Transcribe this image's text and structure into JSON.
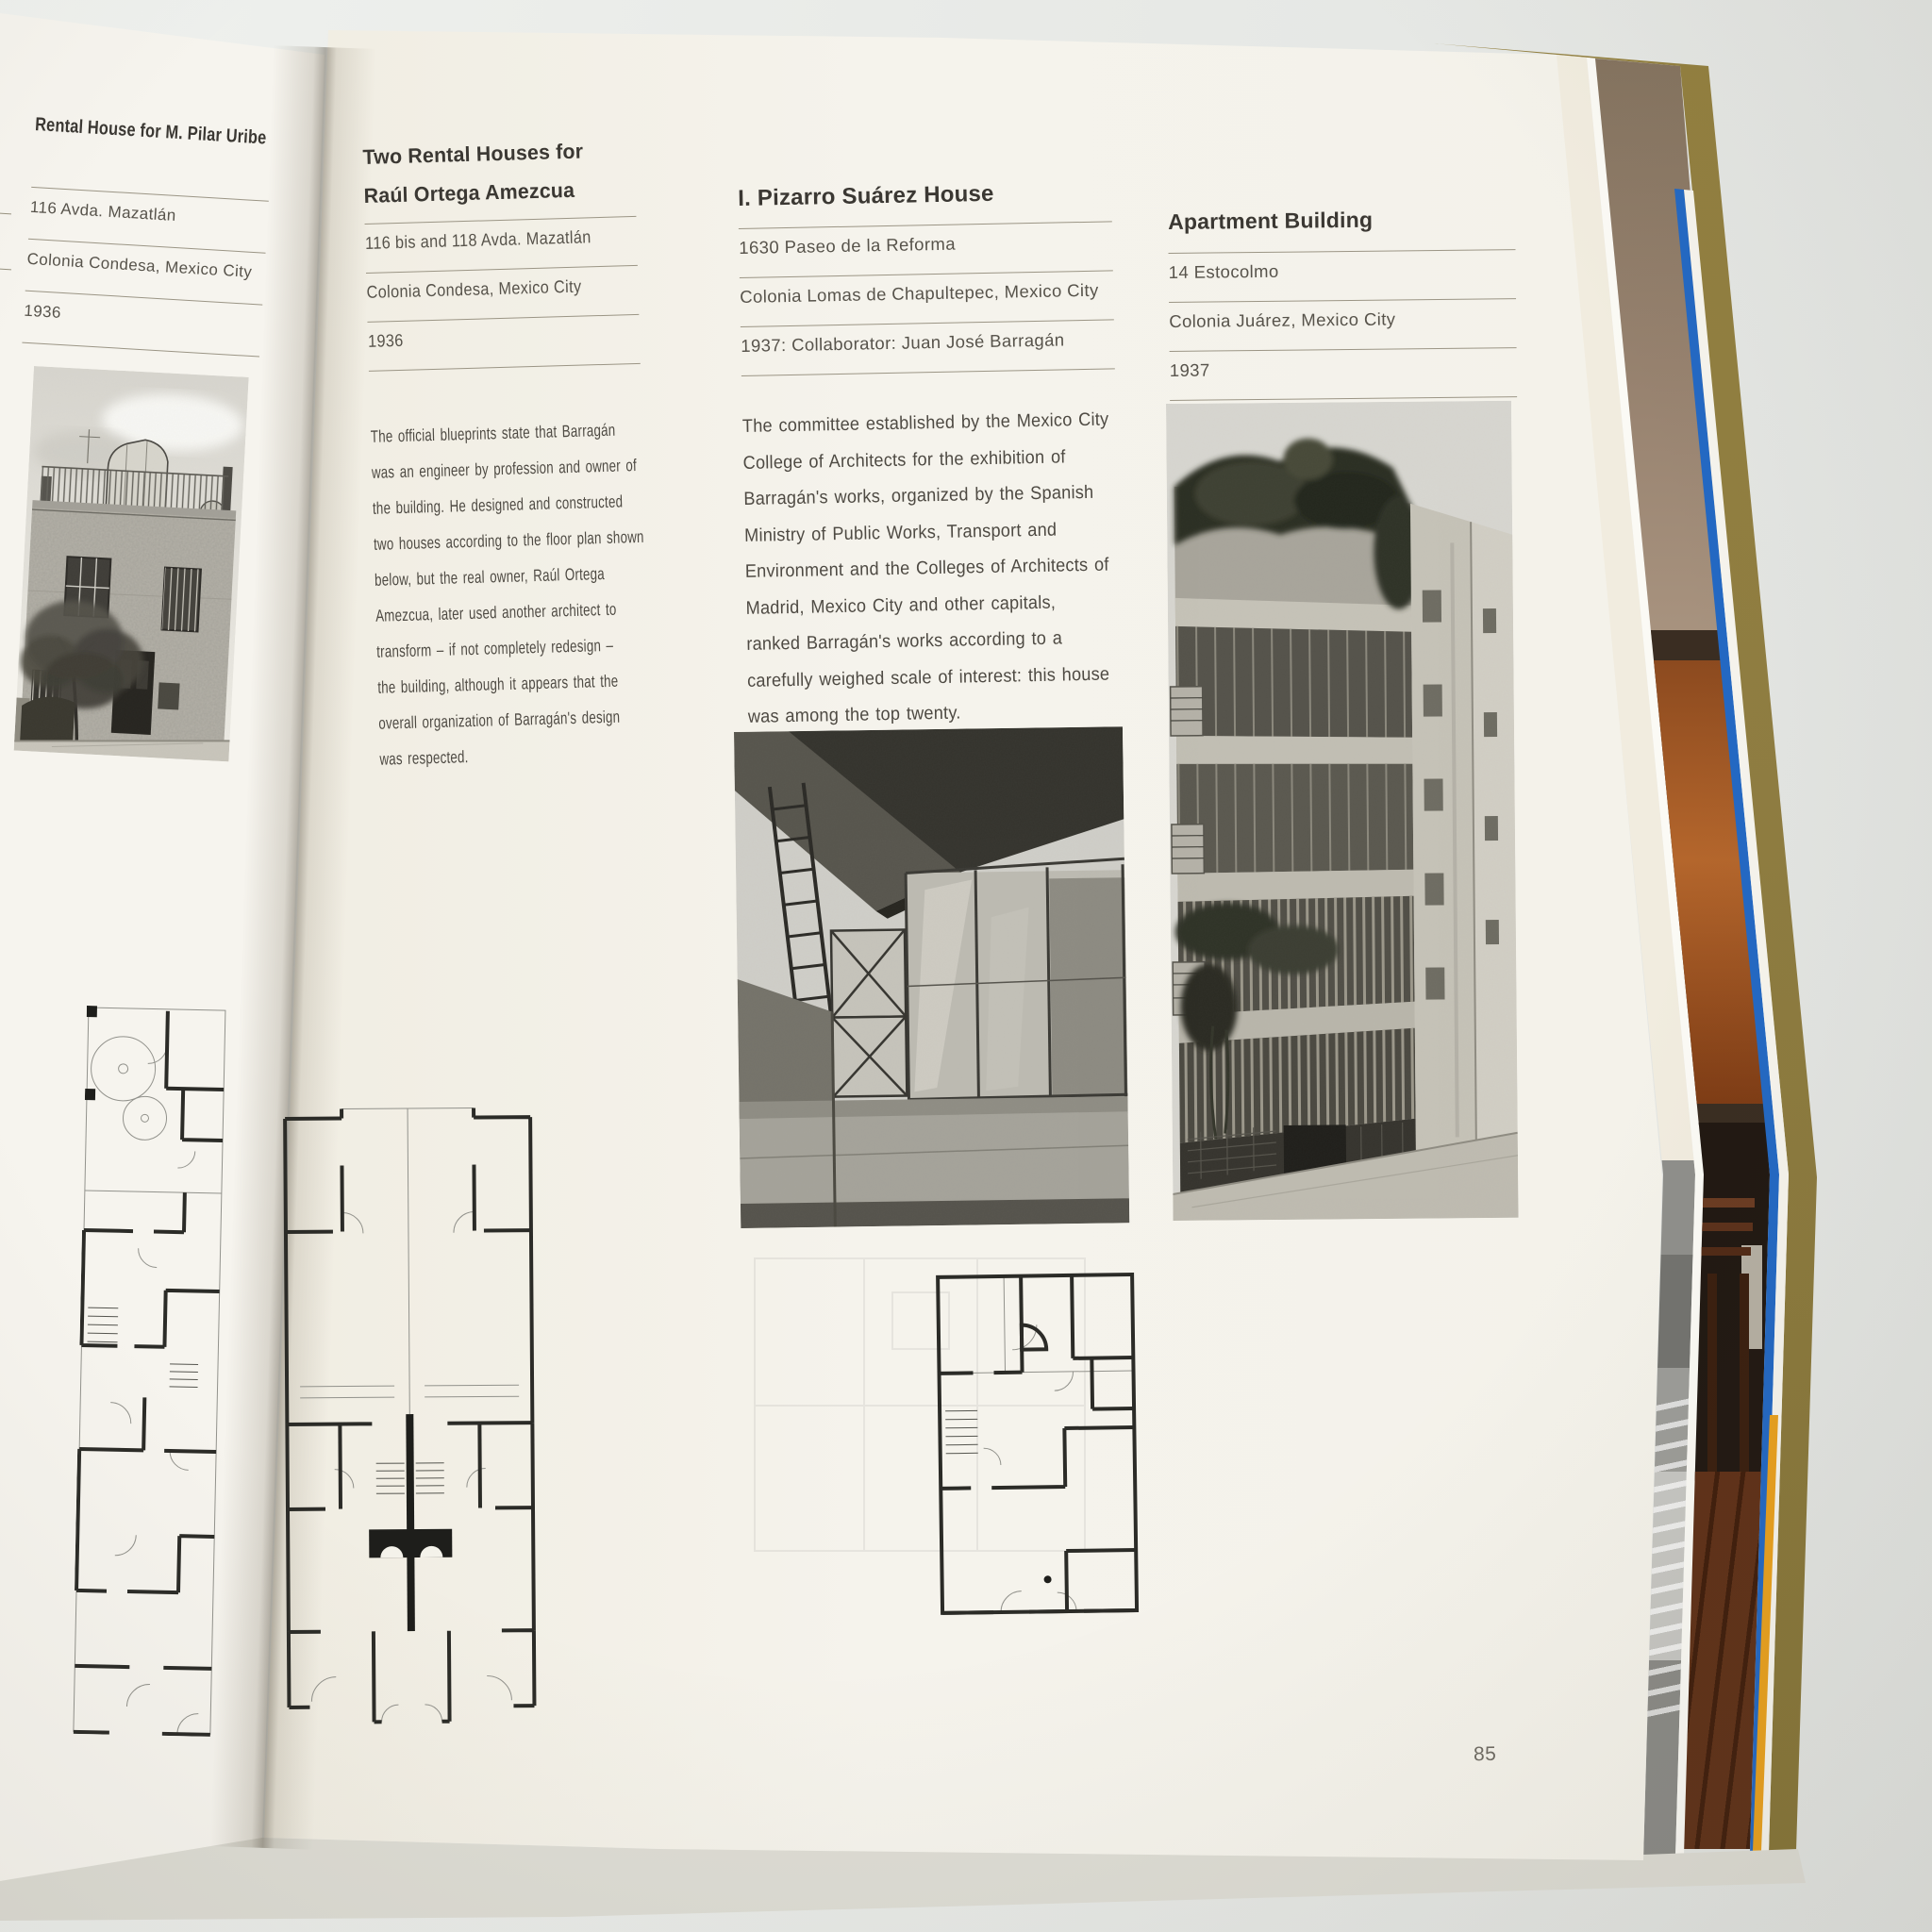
{
  "book": {
    "left_page": {
      "uribe": {
        "title": "Rental House for M. Pilar Uribe",
        "address": [
          "116 Avda. Mazatlán",
          "Colonia Condesa, Mexico City",
          "1936"
        ]
      }
    },
    "right_page": {
      "ortega": {
        "title": "Two Rental Houses for\nRaúl Ortega Amezcua",
        "address": [
          "116 bis and 118 Avda. Mazatlán",
          "Colonia Condesa, Mexico City",
          "1936"
        ],
        "body": "The official blueprints state that Barragán\nwas an engineer by profession and owner of\nthe building. He designed and constructed\ntwo houses according to the floor plan shown\nbelow, but the real owner, Raúl Ortega\nAmezcua, later used another architect to\ntransform – if not completely redesign –\nthe building, although it appears that the\noverall organization of Barragán's design\nwas respected."
      },
      "pizarro": {
        "title": "I. Pizarro Suárez House",
        "address": [
          "1630 Paseo de la Reforma",
          "Colonia Lomas de Chapultepec, Mexico City",
          "1937: Collaborator: Juan José Barragán"
        ],
        "body": "The committee established by the Mexico City\nCollege of Architects for the exhibition of\nBarragán's works, organized by the Spanish\nMinistry of Public Works, Transport and\nEnvironment and the Colleges of Architects of\nMadrid, Mexico City and other capitals,\nranked Barragán's works according to a\ncarefully weighed scale of interest: this house\nwas among the top twenty.",
        "page_number": "85"
      },
      "apartment": {
        "title": "Apartment Building",
        "address": [
          "14 Estocolmo",
          "Colonia Juárez, Mexico City",
          "1937"
        ]
      }
    },
    "colors": {
      "endpaper_blue": "#2368c3",
      "cover_olive": "#8f7d41",
      "jacket_orange": "#e8a01e",
      "artwork_orange": "#b4662c",
      "page_cream": "#f4f2ea"
    }
  }
}
